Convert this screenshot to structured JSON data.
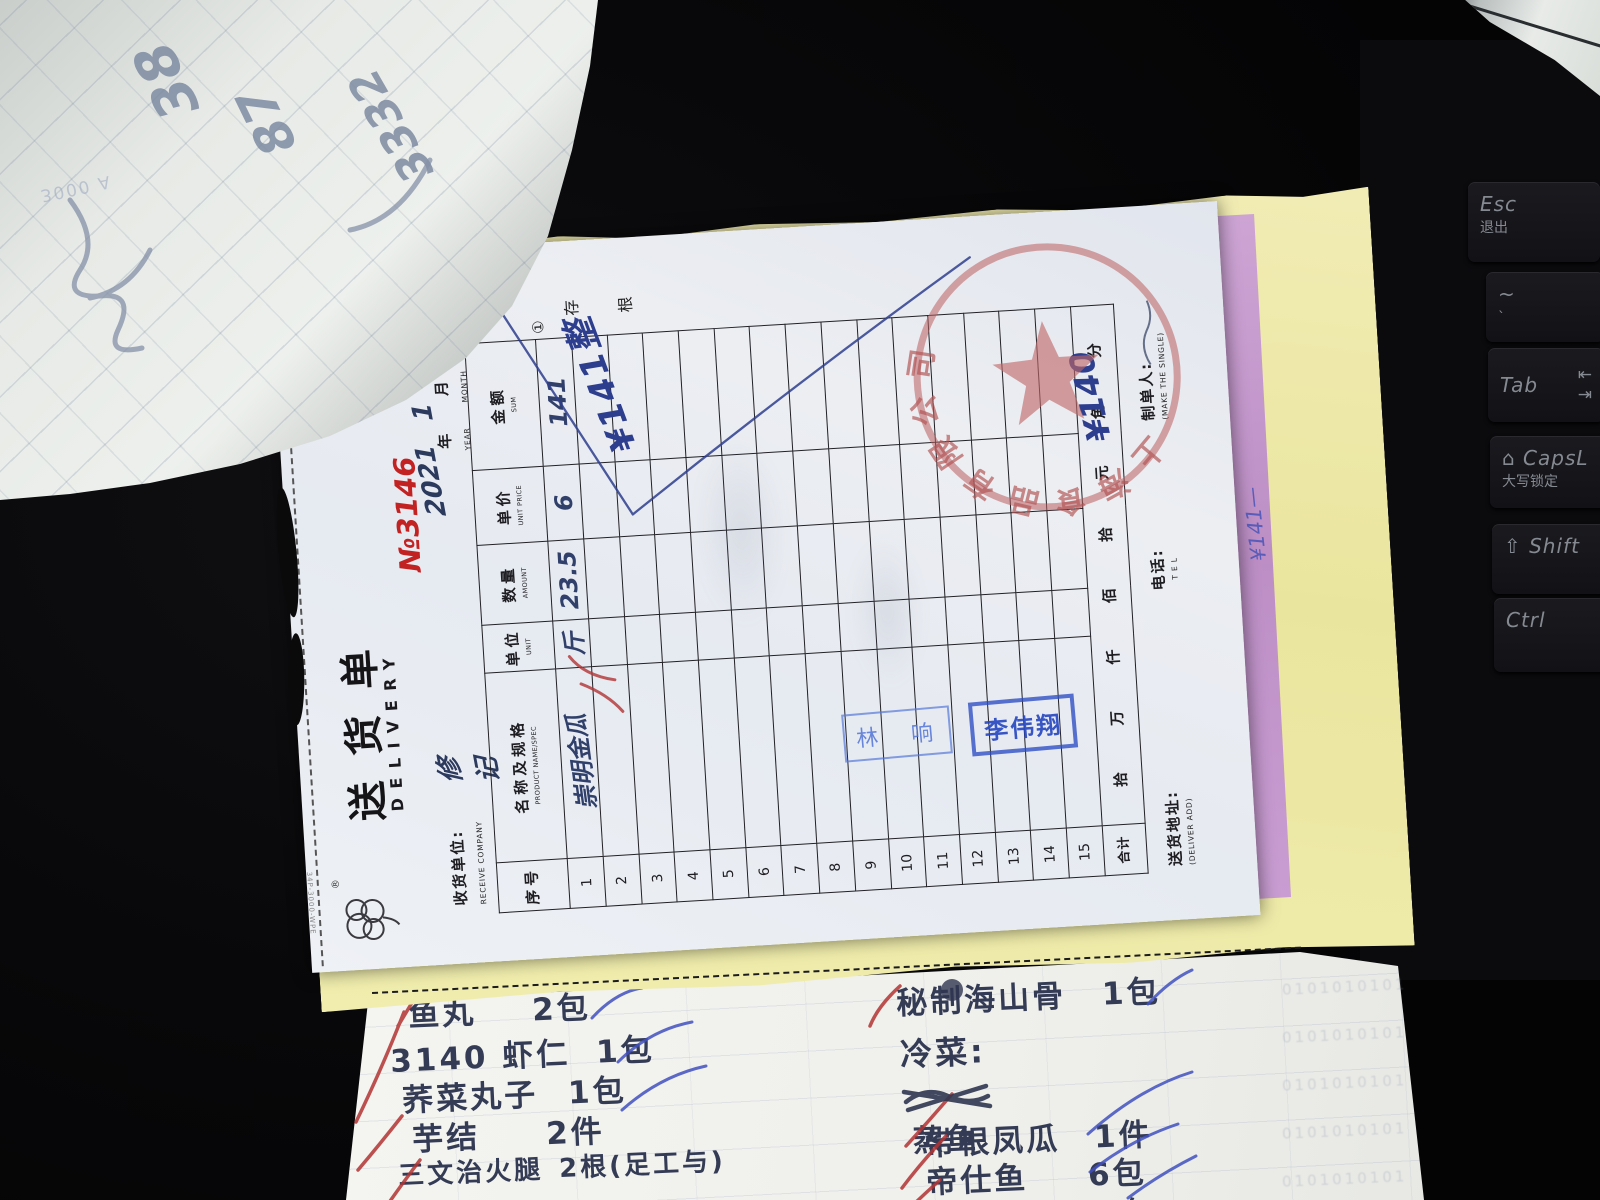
{
  "delivery_note": {
    "serial_edge_text": "34P-3000-WPE",
    "brand_mark": "®",
    "title": "送货单",
    "subtitle": "DELIVERY",
    "number_label": "№",
    "number": "3146",
    "number_color": "#c32222",
    "copy_mark": "①",
    "copy_chars": [
      "存",
      "根"
    ],
    "receive_company_label": "收货单位:",
    "receive_company_en": "RECEIVE COMPANY",
    "receive_company_written": "修记",
    "date": {
      "year_written": "2021",
      "year_label": "年",
      "year_en": "YEAR",
      "month_written": "1",
      "month_label": "月",
      "month_en": "MONTH",
      "day_written": "9",
      "day_label": "日",
      "day_en": "DAY"
    },
    "table": {
      "headers": [
        {
          "cn": "序号",
          "en": ""
        },
        {
          "cn": "名称及规格",
          "en": "PRODUCT NAME/SPEC"
        },
        {
          "cn": "单位",
          "en": "UNIT"
        },
        {
          "cn": "数量",
          "en": "AMOUNT"
        },
        {
          "cn": "单价",
          "en": "UNIT PRICE"
        },
        {
          "cn": "金额",
          "en": "SUM"
        }
      ],
      "row_count": 15,
      "rows": [
        {
          "no": "1",
          "name": "崇明金瓜",
          "unit": "斤",
          "amount": "23.5",
          "price": "6",
          "sum": "141"
        }
      ],
      "total_label": "合计",
      "total_units": "拾 万 仟 佰 拾 元 角 分",
      "total_written": "¥140"
    },
    "margin_note_written": "¥141整",
    "footer": {
      "address_label": "送货地址:",
      "address_en": "(DELIVER ADD)",
      "tel_label": "电话:",
      "tel_en": "T E L",
      "maker_label": "制单人:",
      "maker_en": "(MAKE THE SINGLE)"
    },
    "red_stamp_text": "上海食品有限公司",
    "name_stamps": [
      "林 响",
      "李伟翔"
    ],
    "strip_carbon_note": "¥141—"
  },
  "bottom_sheet": {
    "left_items": [
      {
        "name": "鱼丸",
        "qty": "2包"
      },
      {
        "name": "3140 虾仁",
        "qty": "1包"
      },
      {
        "name": "荞菜丸子",
        "qty": "1包"
      },
      {
        "name": "芋结",
        "qty": "2件"
      },
      {
        "name": "三文治火腿",
        "qty": "2根(足工与)"
      }
    ],
    "right_item_top": {
      "name": "秘制海山骨",
      "qty": "1包"
    },
    "right_heading": "冷菜:",
    "right_item_struck": "蒸鱼",
    "right_items": [
      {
        "name": "带根凤瓜",
        "qty": "1件"
      },
      {
        "name": "帝仕鱼",
        "qty": "6包"
      },
      {
        "name": "糟米红枣",
        "qty": "2包"
      }
    ],
    "bleedthrough_text": "0101010101"
  },
  "curled_sheet": {
    "numbers": [
      "38",
      "87",
      "3332"
    ],
    "faint_text": "3000 A"
  },
  "keyboard": {
    "keys": [
      {
        "main": "Esc",
        "sub": "退出"
      },
      {
        "main": "~",
        "sub": "`"
      },
      {
        "main": "Tab",
        "sub": "⇤\n⇥"
      },
      {
        "main": "⌂ CapsL",
        "sub": "大写锁定"
      },
      {
        "main": "⇧ Shift",
        "sub": ""
      },
      {
        "main": "Ctrl",
        "sub": ""
      }
    ]
  }
}
